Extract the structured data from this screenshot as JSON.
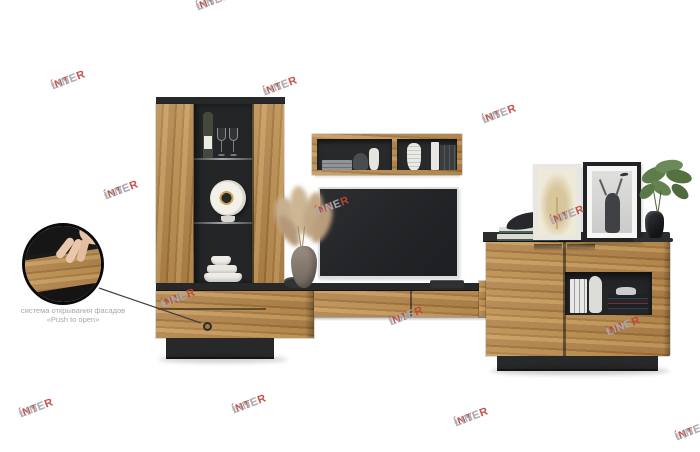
{
  "brand_watermark": {
    "text_primary": "ÍNTER",
    "text_secondary": "LINE",
    "registered_mark": "®",
    "color_primary": "#c0443c",
    "color_secondary": "#a6adb3",
    "rotation_deg": -21,
    "positions": [
      {
        "x": 195,
        "y": 3
      },
      {
        "x": 50,
        "y": 82
      },
      {
        "x": 262,
        "y": 88
      },
      {
        "x": 481,
        "y": 116
      },
      {
        "x": 103,
        "y": 192
      },
      {
        "x": 314,
        "y": 208
      },
      {
        "x": 549,
        "y": 217
      },
      {
        "x": 160,
        "y": 300
      },
      {
        "x": 388,
        "y": 318
      },
      {
        "x": 605,
        "y": 328
      },
      {
        "x": 18,
        "y": 410
      },
      {
        "x": 231,
        "y": 406
      },
      {
        "x": 453,
        "y": 419
      },
      {
        "x": 674,
        "y": 433
      }
    ]
  },
  "annotation": {
    "line1": "система открывания фасадов",
    "line2": "«Push to open»",
    "text_color": "#a8a8a8"
  },
  "palette": {
    "background": "#ffffff",
    "wood_light": "#c69b5d",
    "wood_mid": "#b5894c",
    "wood_dark": "#9d7038",
    "frame_dark": "#26282a",
    "tv_screen": "#24262a"
  }
}
